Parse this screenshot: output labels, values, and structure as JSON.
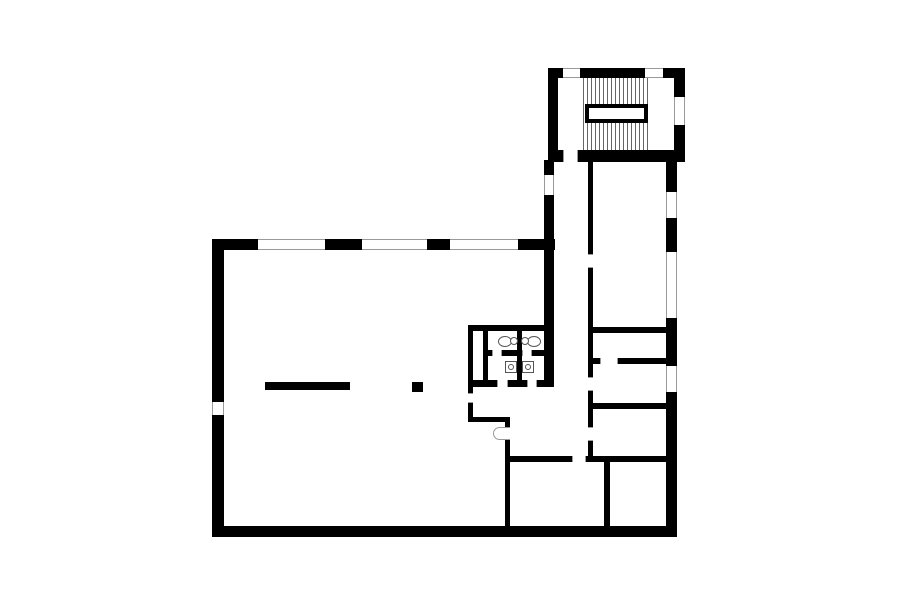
{
  "canvas": {
    "width": 900,
    "height": 604,
    "background": "#ffffff"
  },
  "plan": {
    "wall_color": "#000000",
    "frame_line_color": "#9a9a9a",
    "fixture_line_color": "#555555",
    "stair_tread_color": "#666666",
    "walls": [
      {
        "name": "wall-bigroom-left",
        "x": 212,
        "y": 239,
        "w": 12,
        "h": 298
      },
      {
        "name": "wall-bigroom-top-seg1",
        "x": 212,
        "y": 239,
        "w": 46,
        "h": 11
      },
      {
        "name": "wall-bigroom-top-seg2",
        "x": 325,
        "y": 239,
        "w": 37,
        "h": 11
      },
      {
        "name": "wall-bigroom-top-seg3",
        "x": 427,
        "y": 239,
        "w": 23,
        "h": 11
      },
      {
        "name": "wall-bigroom-top-seg4",
        "x": 518,
        "y": 239,
        "w": 37,
        "h": 11
      },
      {
        "name": "wall-bottom",
        "x": 212,
        "y": 526,
        "w": 465,
        "h": 11
      },
      {
        "name": "wall-wing-west",
        "x": 544,
        "y": 160,
        "w": 10,
        "h": 225
      },
      {
        "name": "wall-corridor-east",
        "x": 588,
        "y": 162,
        "w": 5,
        "h": 300
      },
      {
        "name": "wall-wing-east",
        "x": 666,
        "y": 160,
        "w": 11,
        "h": 377
      },
      {
        "name": "wall-room-divider-a",
        "x": 593,
        "y": 327,
        "w": 73,
        "h": 6
      },
      {
        "name": "wall-room-divider-b",
        "x": 593,
        "y": 358,
        "w": 73,
        "h": 6
      },
      {
        "name": "wall-room-divider-c",
        "x": 593,
        "y": 403,
        "w": 73,
        "h": 6
      },
      {
        "name": "wall-room-divider-d",
        "x": 508,
        "y": 456,
        "w": 158,
        "h": 6
      },
      {
        "name": "wall-bottomrooms-divider",
        "x": 604,
        "y": 462,
        "w": 6,
        "h": 64
      },
      {
        "name": "wall-bigroom-se-vert",
        "x": 505,
        "y": 420,
        "w": 5,
        "h": 106
      },
      {
        "name": "wall-lobby-horiz",
        "x": 468,
        "y": 417,
        "w": 42,
        "h": 5
      },
      {
        "name": "wall-wc-top",
        "x": 468,
        "y": 325,
        "w": 76,
        "h": 6
      },
      {
        "name": "wall-wc-west",
        "x": 468,
        "y": 325,
        "w": 5,
        "h": 97
      },
      {
        "name": "wall-wc-inner-west",
        "x": 483,
        "y": 331,
        "w": 5,
        "h": 56
      },
      {
        "name": "wall-wc-center",
        "x": 517,
        "y": 331,
        "w": 5,
        "h": 56
      },
      {
        "name": "wall-wc-mid",
        "x": 483,
        "y": 350,
        "w": 61,
        "h": 6
      },
      {
        "name": "wall-wc-bottom",
        "x": 468,
        "y": 380,
        "w": 86,
        "h": 7
      },
      {
        "name": "wall-tower-top-seg1",
        "x": 548,
        "y": 68,
        "w": 15,
        "h": 10
      },
      {
        "name": "wall-tower-top-seg2",
        "x": 580,
        "y": 68,
        "w": 65,
        "h": 10
      },
      {
        "name": "wall-tower-top-seg3",
        "x": 663,
        "y": 68,
        "w": 22,
        "h": 10
      },
      {
        "name": "wall-tower-left",
        "x": 548,
        "y": 68,
        "w": 10,
        "h": 92
      },
      {
        "name": "wall-tower-right",
        "x": 674,
        "y": 68,
        "w": 11,
        "h": 92
      },
      {
        "name": "wall-tower-bottom",
        "x": 548,
        "y": 150,
        "w": 137,
        "h": 12
      }
    ],
    "doors": [
      {
        "name": "door-tower-to-corridor",
        "x": 563,
        "y": 150,
        "w": 15,
        "h": 12,
        "orient": "h"
      },
      {
        "name": "door-corridor-room1",
        "x": 588,
        "y": 254,
        "w": 5,
        "h": 14,
        "orient": "v"
      },
      {
        "name": "door-corridor-room3",
        "x": 588,
        "y": 377,
        "w": 5,
        "h": 14,
        "orient": "v"
      },
      {
        "name": "door-corridor-room4",
        "x": 588,
        "y": 427,
        "w": 5,
        "h": 14,
        "orient": "v"
      },
      {
        "name": "door-divider-b",
        "x": 600,
        "y": 358,
        "w": 18,
        "h": 6,
        "orient": "h"
      },
      {
        "name": "door-divider-d",
        "x": 572,
        "y": 456,
        "w": 14,
        "h": 6,
        "orient": "h"
      },
      {
        "name": "door-bigroom-se",
        "x": 505,
        "y": 427,
        "w": 5,
        "h": 13,
        "orient": "v"
      },
      {
        "name": "door-wc-west",
        "x": 468,
        "y": 393,
        "w": 5,
        "h": 10,
        "orient": "v"
      },
      {
        "name": "door-wc-mid-left",
        "x": 492,
        "y": 350,
        "w": 10,
        "h": 6,
        "orient": "h"
      },
      {
        "name": "door-wc-mid-right",
        "x": 522,
        "y": 350,
        "w": 10,
        "h": 6,
        "orient": "h"
      },
      {
        "name": "door-wc-bottom-left",
        "x": 497,
        "y": 380,
        "w": 11,
        "h": 7,
        "orient": "h"
      },
      {
        "name": "door-wc-bottom-right",
        "x": 527,
        "y": 380,
        "w": 10,
        "h": 7,
        "orient": "h"
      }
    ],
    "windows": [
      {
        "name": "window-top-1",
        "x": 258,
        "y": 239,
        "w": 67,
        "h": 11,
        "orient": "h"
      },
      {
        "name": "window-top-2",
        "x": 362,
        "y": 239,
        "w": 65,
        "h": 11,
        "orient": "h"
      },
      {
        "name": "window-top-3",
        "x": 450,
        "y": 239,
        "w": 68,
        "h": 11,
        "orient": "h"
      },
      {
        "name": "window-left-wall",
        "x": 212,
        "y": 402,
        "w": 12,
        "h": 13,
        "orient": "v"
      },
      {
        "name": "window-wing-west",
        "x": 544,
        "y": 175,
        "w": 10,
        "h": 20,
        "orient": "v"
      },
      {
        "name": "window-wing-east-1",
        "x": 666,
        "y": 192,
        "w": 11,
        "h": 26,
        "orient": "v"
      },
      {
        "name": "window-wing-east-2",
        "x": 666,
        "y": 252,
        "w": 11,
        "h": 66,
        "orient": "v"
      },
      {
        "name": "window-wing-east-3",
        "x": 666,
        "y": 366,
        "w": 11,
        "h": 26,
        "orient": "v"
      },
      {
        "name": "window-tower-top-1",
        "x": 563,
        "y": 68,
        "w": 17,
        "h": 10,
        "orient": "h"
      },
      {
        "name": "window-tower-top-2",
        "x": 645,
        "y": 68,
        "w": 18,
        "h": 10,
        "orient": "h"
      },
      {
        "name": "window-tower-right",
        "x": 674,
        "y": 97,
        "w": 11,
        "h": 28,
        "orient": "v"
      }
    ],
    "stair": {
      "name": "stairs",
      "treads": {
        "x": 583,
        "y": 78,
        "w": 65,
        "h": 72,
        "spacing": 4
      },
      "void": {
        "name": "stair-void",
        "x": 585,
        "y": 104,
        "w": 63,
        "h": 19,
        "border": 4
      }
    },
    "toilets": [
      {
        "name": "toilet-left",
        "bowl": {
          "x": 498,
          "y": 336,
          "w": 14,
          "h": 11
        },
        "tank": {
          "x": 510,
          "y": 337,
          "w": 8,
          "h": 8
        }
      },
      {
        "name": "toilet-right",
        "bowl": {
          "x": 527,
          "y": 336,
          "w": 14,
          "h": 11
        },
        "tank": {
          "x": 521,
          "y": 337,
          "w": 8,
          "h": 8
        }
      }
    ],
    "sinks": [
      {
        "name": "sink-left",
        "x": 505,
        "y": 361,
        "w": 12,
        "h": 12
      },
      {
        "name": "sink-right",
        "x": 522,
        "y": 361,
        "w": 12,
        "h": 12
      }
    ],
    "door_arc": {
      "name": "door-swing-arc",
      "x": 493,
      "y": 427,
      "w": 13,
      "h": 13
    },
    "furniture": [
      {
        "name": "bigroom-counter-bar",
        "x": 265,
        "y": 382,
        "w": 85,
        "h": 8
      },
      {
        "name": "bigroom-column",
        "x": 412,
        "y": 382,
        "w": 11,
        "h": 10
      }
    ]
  }
}
